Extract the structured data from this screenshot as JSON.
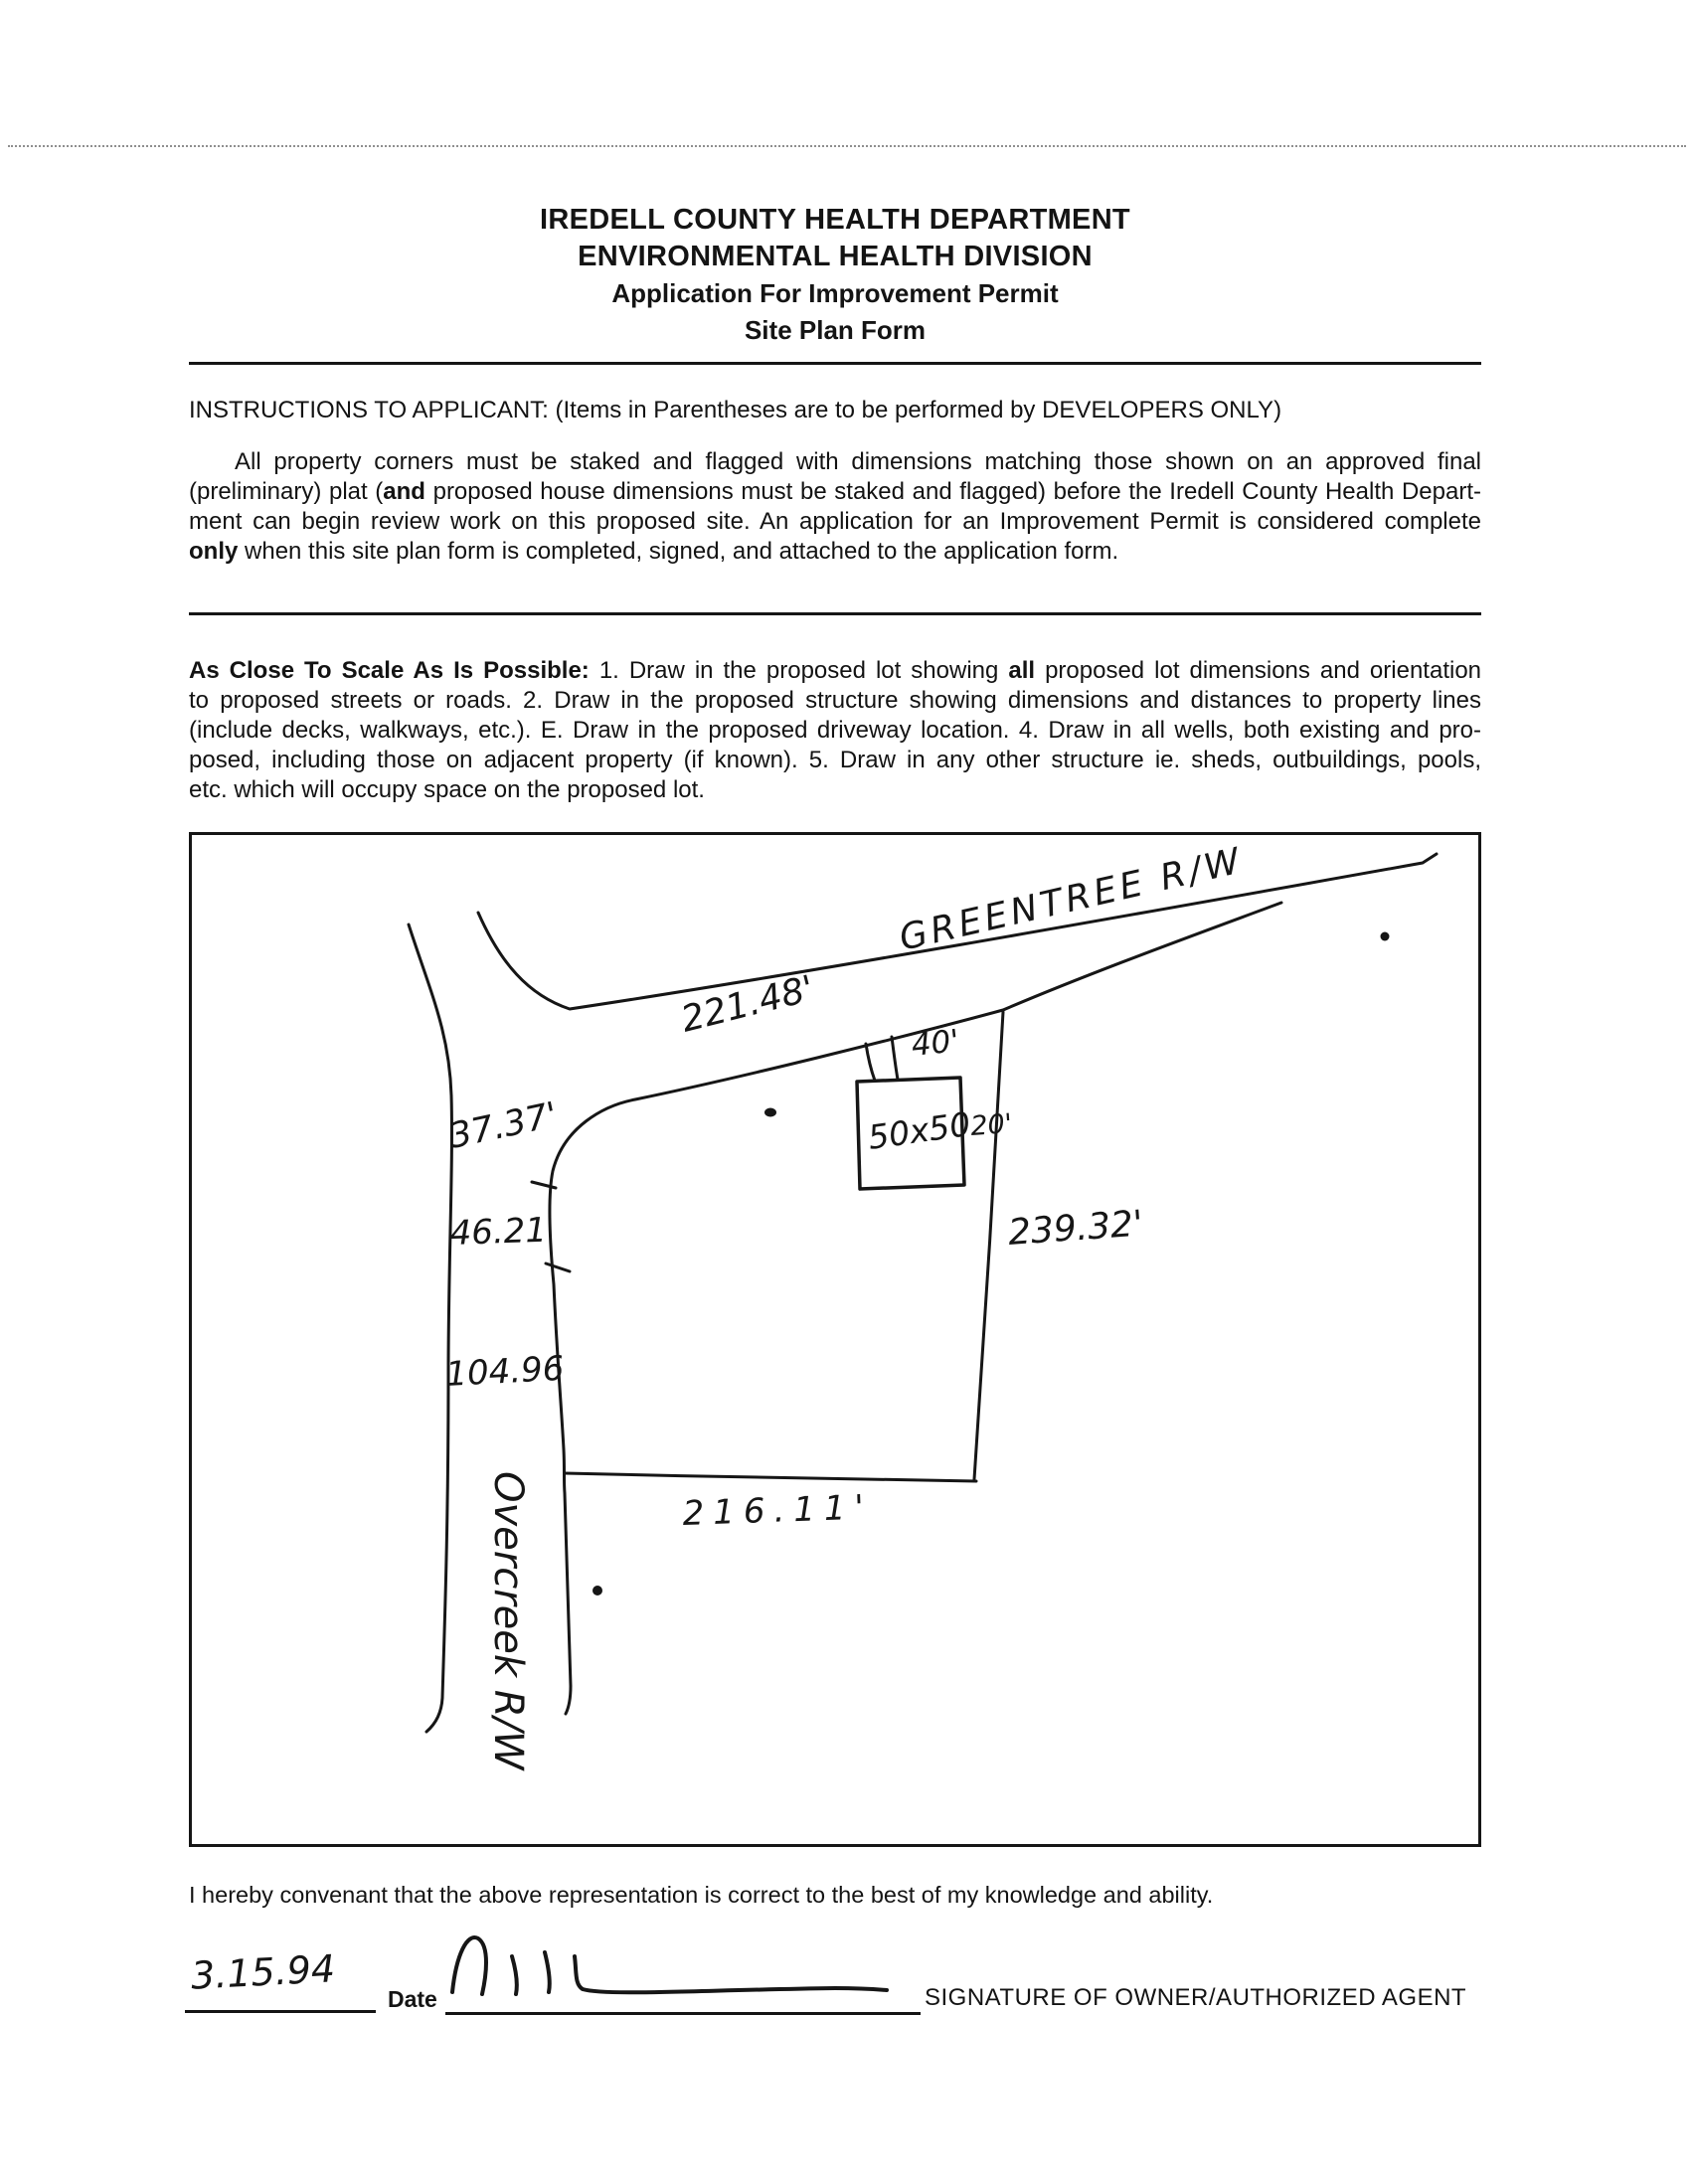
{
  "header": {
    "line1": "IREDELL COUNTY HEALTH DEPARTMENT",
    "line2": "ENVIRONMENTAL HEALTH DIVISION",
    "line3": "Application For Improvement Permit",
    "line4": "Site Plan Form"
  },
  "instructions": {
    "heading": "INSTRUCTIONS TO APPLICANT: (Items in Parentheses are to be performed by DEVELOPERS ONLY)",
    "para1": {
      "l1": "All property corners must be staked and flagged with dimensions matching those shown on an approved final",
      "l2a": "(preliminary) plat (",
      "l2b": "and",
      "l2c": " proposed house dimensions must be staked and flagged) before the Iredell County Health Depart-",
      "l3": "ment can begin review work on this proposed site. An application for an Improvement Permit is considered complete",
      "l4a": "only",
      "l4b": " when this site plan form is completed, signed, and attached to the application form."
    },
    "scale_note": {
      "lead": "As Close To Scale As Is Possible:",
      "l1a": " 1. Draw in the proposed lot showing ",
      "l1b": "all",
      "l1c": " proposed lot dimensions and orientation",
      "l2": "to proposed streets or roads. 2. Draw in the proposed structure showing dimensions and distances to property lines",
      "l3": "(include decks, walkways, etc.). E. Draw in the proposed driveway location. 4. Draw in all wells, both existing and pro-",
      "l4": "posed, including those on adjacent property (if known). 5. Draw in any other structure ie. sheds, outbuildings, pools,",
      "l5": "etc. which will occupy space on the proposed lot."
    }
  },
  "site_plan": {
    "roads": {
      "greentree": "GREENTREE R/W",
      "overcreek": "Overcreek R/W"
    },
    "dimensions": {
      "north_boundary": "221.48'",
      "driveway_width": "40'",
      "house_size": "50x50",
      "house_setback_east": "20'",
      "east_boundary": "239.32'",
      "corner_curve": "37.37'",
      "west_boundary_upper": "46.21",
      "west_boundary_lower": "104.96",
      "south_boundary": "216.11'"
    }
  },
  "covenant": "I hereby convenant that the above representation is correct to the best of my knowledge and ability.",
  "signature_block": {
    "date_value": "3.15.94",
    "date_label": "Date",
    "signature_label": "SIGNATURE OF OWNER/AUTHORIZED AGENT"
  }
}
